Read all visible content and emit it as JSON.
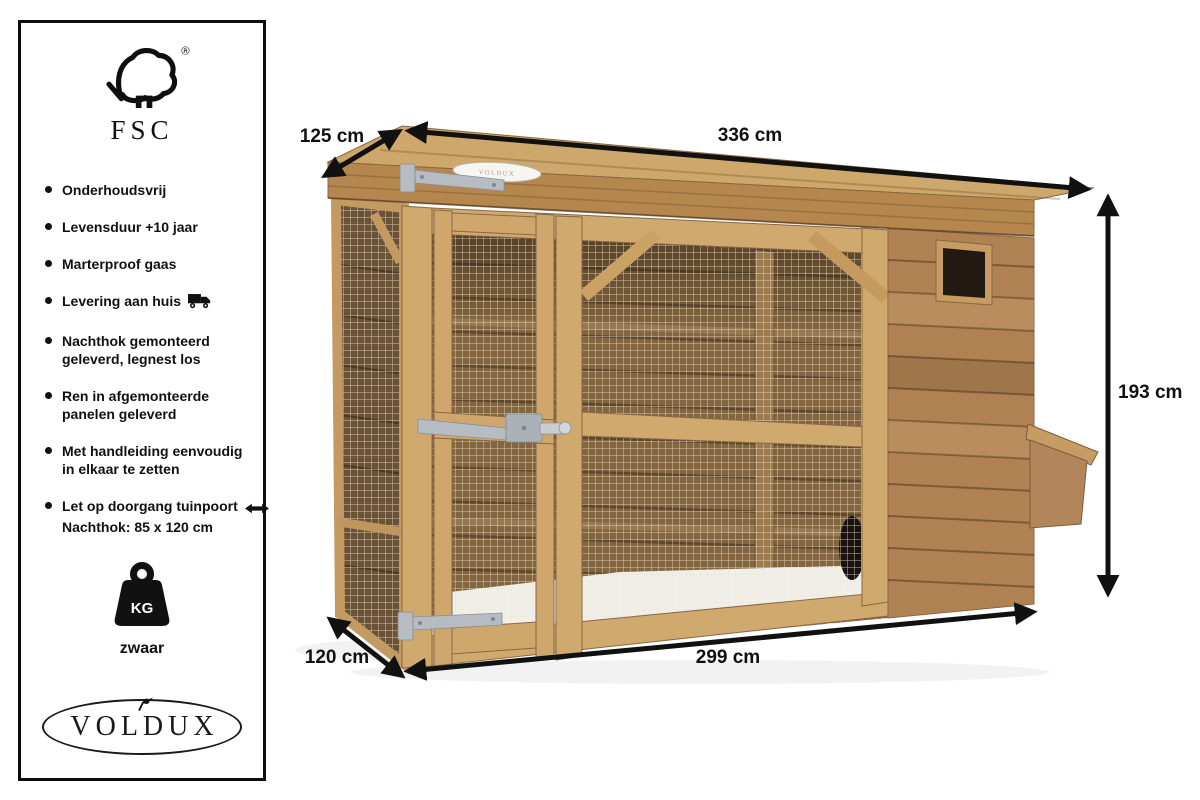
{
  "sidebar": {
    "fsc": {
      "name": "FSC",
      "registered": "®"
    },
    "features": [
      {
        "line1": "Onderhoudsvrij"
      },
      {
        "line1": "Levensduur +10 jaar"
      },
      {
        "line1": "Marterproof gaas"
      },
      {
        "line1": "Levering aan huis",
        "icon": "delivery-truck"
      },
      {
        "line1": "Nachthok gemonteerd",
        "line2": "geleverd, legnest los"
      },
      {
        "line1": "Ren in afgemonteerde",
        "line2": "panelen geleverd"
      },
      {
        "line1": "Met handleiding eenvoudig",
        "line2": "in elkaar te zetten"
      },
      {
        "line1": "Let op doorgang tuinpoort",
        "line2": "Nachthok: 85 x 120 cm",
        "icon": "double-arrow"
      }
    ],
    "weight": {
      "unit": "KG",
      "label": "zwaar"
    },
    "brand": "VOLDUX"
  },
  "diagram": {
    "dimensions": {
      "top_depth": "125 cm",
      "top_width": "336 cm",
      "height": "193 cm",
      "bottom_width": "299 cm",
      "bottom_depth": "120 cm"
    },
    "roof_badge": "VOLDUX",
    "colors": {
      "arrow": "#111111",
      "wood_frame": "#d0a96f",
      "wood_fascia": "#b5874f",
      "wood_planks": "#b08253",
      "interior": "#83653f",
      "metal": "#b6bcc1",
      "floor": "#f1efe9"
    }
  }
}
